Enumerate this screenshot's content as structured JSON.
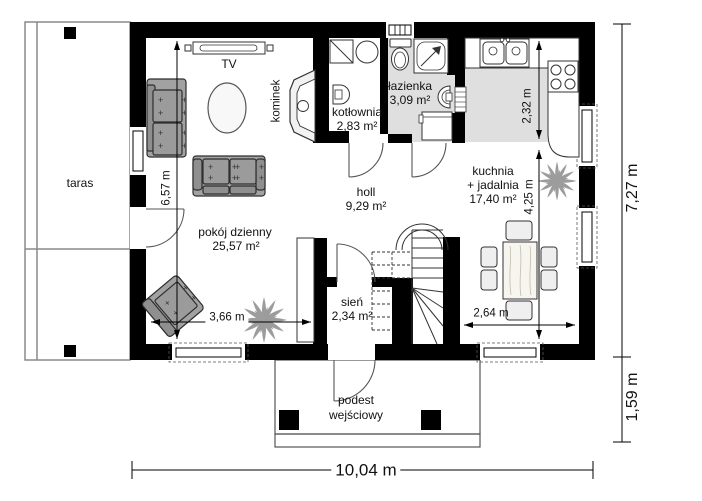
{
  "rooms": {
    "taras": {
      "name": "taras"
    },
    "tv": {
      "name": "TV"
    },
    "kominek": {
      "name": "kominek"
    },
    "kotlownia": {
      "name": "kotłownia",
      "area": "2,83 m²"
    },
    "lazienka": {
      "name": "łazienka",
      "area": "3,09 m²"
    },
    "kuchnia": {
      "name": "kuchnia",
      "name2": "+ jadalnia",
      "area": "17,40 m²"
    },
    "holl": {
      "name": "holl",
      "area": "9,29 m²"
    },
    "pokoj": {
      "name": "pokój dzienny",
      "area": "25,57 m²"
    },
    "sien": {
      "name": "sień",
      "area": "2,34 m²"
    },
    "podest": {
      "name": "podest",
      "name2": "wejściowy"
    }
  },
  "dimensions": {
    "width_total": "10,04 m",
    "height_total": "7,27 m",
    "porch": "1,59 m",
    "living_h": "6,57 m",
    "living_w": "3,66 m",
    "kitchen_h": "2,32 m",
    "dining_h": "4,25 m",
    "dining_w": "2,64 m"
  },
  "colors": {
    "wall": "#000000",
    "wet_floor": "#dfdfdf",
    "furniture": "#a2a2a2",
    "line": "#444444"
  }
}
